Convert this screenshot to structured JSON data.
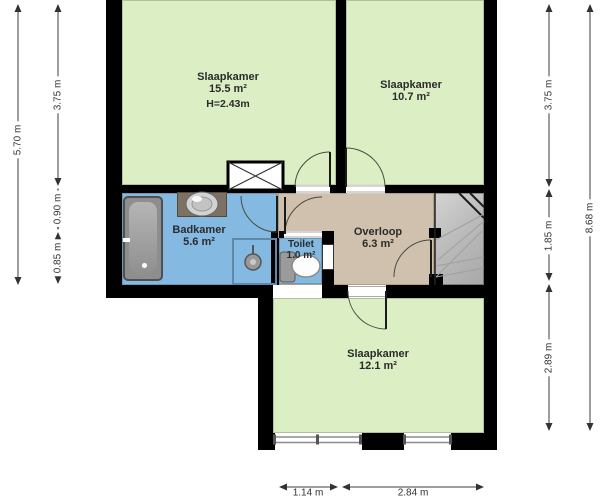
{
  "plan": {
    "rooms": [
      {
        "name": "slaapkamer-1",
        "label": "Slaapkamer",
        "area": "15.5 m²",
        "note": "H=2.43m"
      },
      {
        "name": "slaapkamer-2",
        "label": "Slaapkamer",
        "area": "10.7 m²"
      },
      {
        "name": "badkamer",
        "label": "Badkamer",
        "area": "5.6 m²"
      },
      {
        "name": "toilet",
        "label": "Toilet",
        "area": "1.0 m²"
      },
      {
        "name": "overloop",
        "label": "Overloop",
        "area": "6.3 m²"
      },
      {
        "name": "slaapkamer-3",
        "label": "Slaapkamer",
        "area": "12.1 m²"
      }
    ],
    "dimensions": {
      "left_outer": "5.70 m",
      "left_segments": [
        "3.75 m",
        "0.90 m",
        "0.85 m"
      ],
      "right_segments": [
        "3.75 m",
        "1.85 m",
        "2.89 m"
      ],
      "right_outer": "8.68 m",
      "bottom_segments": [
        "1.14 m",
        "2.84 m"
      ]
    },
    "colors": {
      "room_green": "#dcefc4",
      "wet_room_blue": "#84b9e1",
      "landing_tan": "#cfc1ad",
      "stairs_gray": "#b9b9b9",
      "wall": "#000000"
    }
  }
}
